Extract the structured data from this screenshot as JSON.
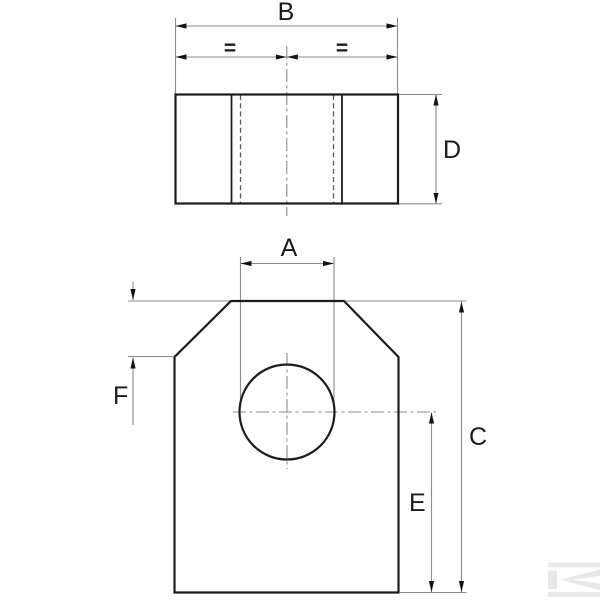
{
  "title": "technical drawing, two views of chamfered plate with through hole",
  "colors": {
    "background": "#ffffff",
    "outline": "#1c1c1c",
    "inner_edge": "#1c1c1c",
    "hidden_line": "#5a5a5a",
    "center_line": "#8c8c8c",
    "dimension_line": "#8c8c8c",
    "arrowhead": "#141414",
    "label_text": "#1a1a1a",
    "watermark": "#e8e8e8"
  },
  "labels": {
    "top_view": {
      "width": "B",
      "equal_left": "=",
      "equal_right": "=",
      "depth": "D"
    },
    "front_view": {
      "hole_width": "A",
      "overall_height": "C",
      "hole_center_to_bottom": "E",
      "chamfer_height": "F"
    }
  },
  "watermark": {
    "name": "kramp-logo"
  }
}
